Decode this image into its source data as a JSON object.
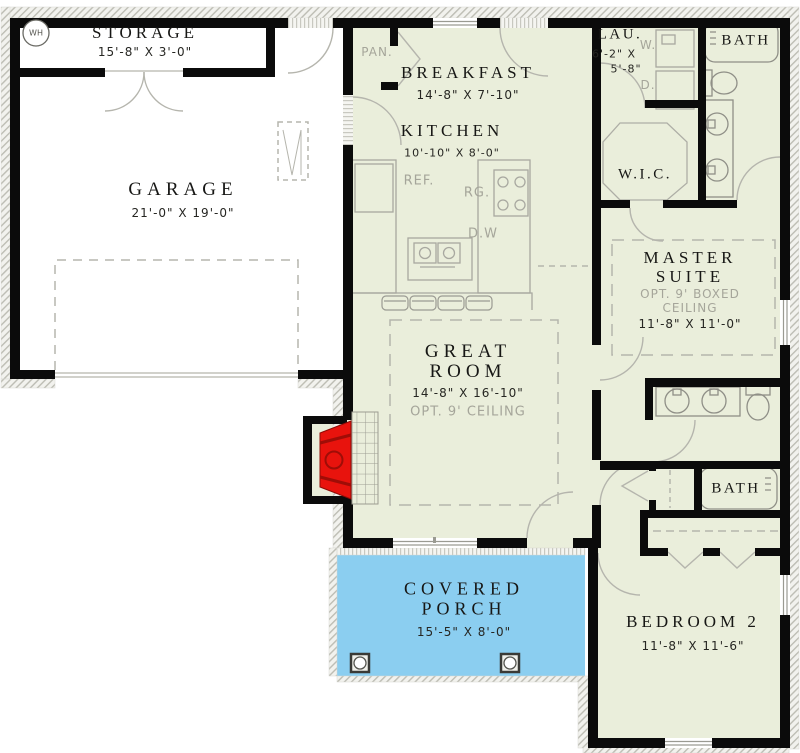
{
  "colors": {
    "interior_fill": "#EAEEDB",
    "porch_fill": "#8BCEF0",
    "fireplace_red": "#E8130D",
    "wall": "#0B0B0B",
    "line_gray": "#B2B2AA"
  },
  "rooms": {
    "storage": {
      "name": "STORAGE",
      "dims": "15'-8\" X 3'-0\""
    },
    "garage": {
      "name": "GARAGE",
      "dims": "21'-0\" X 19'-0\""
    },
    "breakfast": {
      "name": "BREAKFAST",
      "dims": "14'-8\" X 7'-10\""
    },
    "kitchen": {
      "name": "KITCHEN",
      "dims": "10'-10\" X 8'-0\""
    },
    "laundry": {
      "name": "LAU.",
      "dims_line1": "6'-2\" X",
      "dims_line2": "5'-8\""
    },
    "bath_top": {
      "name": "BATH"
    },
    "wic": {
      "name": "W.I.C."
    },
    "master_suite": {
      "name_line1": "MASTER",
      "name_line2": "SUITE",
      "ceiling_note_line1": "OPT. 9' BOXED",
      "ceiling_note_line2": "CEILING",
      "dims": "11'-8\" X 11'-0\""
    },
    "great_room": {
      "name_line1": "GREAT",
      "name_line2": "ROOM",
      "dims": "14'-8\" X 16'-10\"",
      "ceiling_note": "OPT. 9' CEILING"
    },
    "bath_hall": {
      "name": "BATH"
    },
    "covered_porch": {
      "name_line1": "COVERED",
      "name_line2": "PORCH",
      "dims": "15'-5\" X 8'-0\""
    },
    "bedroom2": {
      "name": "BEDROOM 2",
      "dims": "11'-8\" X 11'-6\""
    }
  },
  "fixture_labels": {
    "water_heater": "WH",
    "pantry": "PAN.",
    "refrigerator": "REF.",
    "range": "RG.",
    "dishwasher": "D.W",
    "washer": "W.",
    "dryer": "D."
  }
}
